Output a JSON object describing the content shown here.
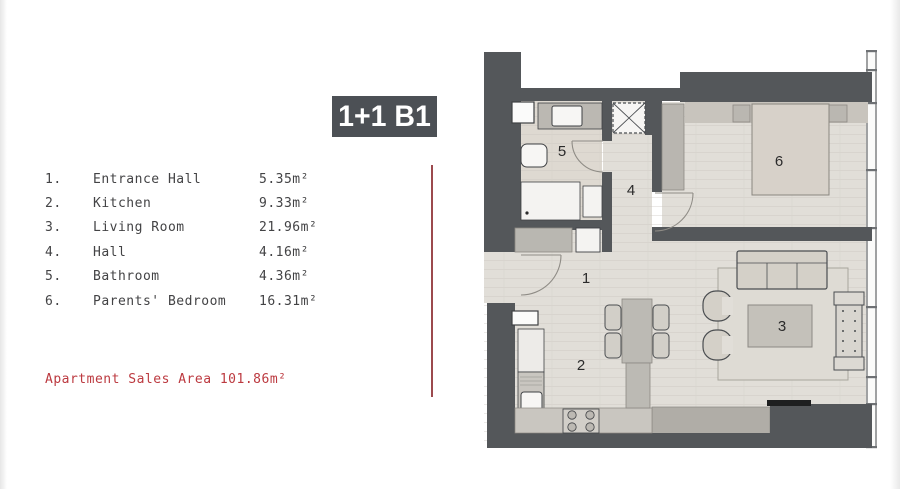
{
  "plan_card": {
    "title": "1+1 B1",
    "title_bg": "#4c5055",
    "accent_red": "#bc3a40",
    "legend": {
      "items": [
        {
          "no": "1.",
          "name": "Entrance Hall",
          "area": "5.35m²"
        },
        {
          "no": "2.",
          "name": "Kitchen",
          "area": "9.33m²"
        },
        {
          "no": "3.",
          "name": "Living Room",
          "area": "21.96m²"
        },
        {
          "no": "4.",
          "name": "Hall",
          "area": "4.16m²"
        },
        {
          "no": "5.",
          "name": "Bathroom",
          "area": "4.36m²"
        },
        {
          "no": "6.",
          "name": "Parents' Bedroom",
          "area": "16.31m²"
        }
      ]
    },
    "sales_area_label": "Apartment Sales Area 101.86m²"
  },
  "floorplan": {
    "wall_color": "#54575a",
    "floor_color": "#e1ded8",
    "bath_floor_color": "#ded9d1",
    "room_labels": {
      "entrance_hall": "1",
      "kitchen": "2",
      "living_room": "3",
      "hall": "4",
      "bathroom": "5",
      "parents_bedroom": "6"
    }
  }
}
